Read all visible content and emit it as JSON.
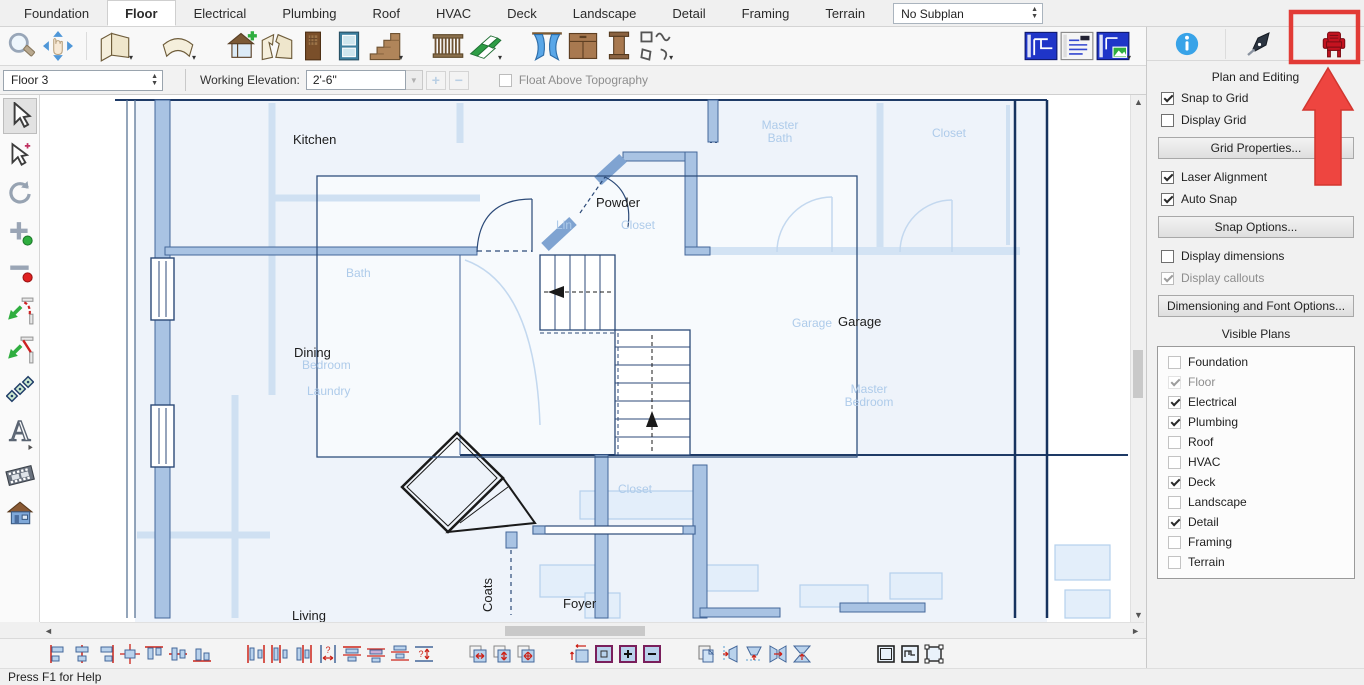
{
  "tab_bar": {
    "tabs": [
      {
        "label": "Foundation"
      },
      {
        "label": "Floor"
      },
      {
        "label": "Electrical"
      },
      {
        "label": "Plumbing"
      },
      {
        "label": "Roof"
      },
      {
        "label": "HVAC"
      },
      {
        "label": "Deck"
      },
      {
        "label": "Landscape"
      },
      {
        "label": "Detail"
      },
      {
        "label": "Framing"
      },
      {
        "label": "Terrain"
      }
    ],
    "active_tab": "Floor",
    "subplan_select_value": "No Subplan"
  },
  "toolbar": {
    "icons": [
      "zoom",
      "pan",
      "straight-wall",
      "curved-wall",
      "build-new-floor",
      "break-wall",
      "door",
      "window",
      "stairs",
      "railing",
      "flooring",
      "curtain",
      "cabinet",
      "column",
      "shapes",
      "plan-view",
      "layout-view",
      "picture-view"
    ]
  },
  "floor_bar": {
    "floor_select_value": "Floor 3",
    "working_elevation_label": "Working Elevation:",
    "working_elevation_value": "2'-6\"",
    "float_above_label": "Float Above Topography",
    "float_above_checked": false
  },
  "left_toolbar": {
    "tools": [
      "select-objects",
      "special-select",
      "rotate",
      "add-node",
      "remove-node",
      "fillet-corner",
      "chamfer-corner",
      "pattern",
      "text",
      "walkthrough",
      "camera-view"
    ]
  },
  "canvas": {
    "room_labels": [
      {
        "text": "Kitchen"
      },
      {
        "text": "Powder"
      },
      {
        "text": "Dining"
      },
      {
        "text": "Garage"
      },
      {
        "text": "Coats"
      },
      {
        "text": "Foyer"
      },
      {
        "text": "Living"
      }
    ],
    "faded_labels": [
      {
        "text": "Master Bath"
      },
      {
        "text": "Closet"
      },
      {
        "text": "Lin"
      },
      {
        "text": "Closet"
      },
      {
        "text": "Bath"
      },
      {
        "text": "Bedroom"
      },
      {
        "text": "Laundry"
      },
      {
        "text": "Garage"
      },
      {
        "text": "Master Bedroom"
      },
      {
        "text": "Closet"
      }
    ]
  },
  "right_panel": {
    "header_icons": [
      "info",
      "pen",
      "furniture"
    ],
    "title": "Plan and Editing",
    "options": [
      {
        "label": "Snap to Grid",
        "checked": true,
        "disabled": false
      },
      {
        "label": "Display Grid",
        "checked": false,
        "disabled": false
      },
      {
        "label": "Laser Alignment",
        "checked": true,
        "disabled": false
      },
      {
        "label": "Auto Snap",
        "checked": true,
        "disabled": false
      },
      {
        "label": "Display dimensions",
        "checked": false,
        "disabled": false
      },
      {
        "label": "Display callouts",
        "checked": true,
        "disabled": true
      }
    ],
    "buttons": [
      {
        "label": "Grid Properties..."
      },
      {
        "label": "Snap Options..."
      },
      {
        "label": "Dimensioning and Font Options..."
      }
    ],
    "visible_plans": {
      "title": "Visible Plans",
      "items": [
        {
          "label": "Foundation",
          "checked": false,
          "disabled": false
        },
        {
          "label": "Floor",
          "checked": true,
          "disabled": true
        },
        {
          "label": "Electrical",
          "checked": true,
          "disabled": false
        },
        {
          "label": "Plumbing",
          "checked": true,
          "disabled": false
        },
        {
          "label": "Roof",
          "checked": false,
          "disabled": false
        },
        {
          "label": "HVAC",
          "checked": false,
          "disabled": false
        },
        {
          "label": "Deck",
          "checked": true,
          "disabled": false
        },
        {
          "label": "Landscape",
          "checked": false,
          "disabled": false
        },
        {
          "label": "Detail",
          "checked": true,
          "disabled": false
        },
        {
          "label": "Framing",
          "checked": false,
          "disabled": false
        },
        {
          "label": "Terrain",
          "checked": false,
          "disabled": false
        }
      ]
    }
  },
  "bottom_toolbar": {
    "icons": [
      "align-left",
      "align-center",
      "align-right",
      "center-both",
      "align-top",
      "align-middle",
      "align-bottom",
      "space-evenly-horizontal",
      "distribute-horizontal",
      "distribute-gap-horizontal",
      "set-horizontal-spacing",
      "space-evenly-vertical",
      "distribute-vertical",
      "distribute-gap-vertical",
      "set-vertical-spacing",
      "stretch-horizontal",
      "stretch-vertical",
      "stretch-both",
      "set-size",
      "frame-object",
      "enlarge",
      "reduce",
      "copy-region",
      "skew-right",
      "skew-down",
      "mirror-horizontal",
      "mirror-vertical",
      "empty-box",
      "plan-box",
      "handle-box"
    ]
  },
  "status_bar": {
    "text": "Press F1 for Help"
  },
  "colors": {
    "wall_blue": "#a9c3e3",
    "faded_plan": "#c9ddf2",
    "annotation_red": "#ee4540",
    "selection": "#30507e",
    "blueprint_blue": "#1f35c8"
  }
}
